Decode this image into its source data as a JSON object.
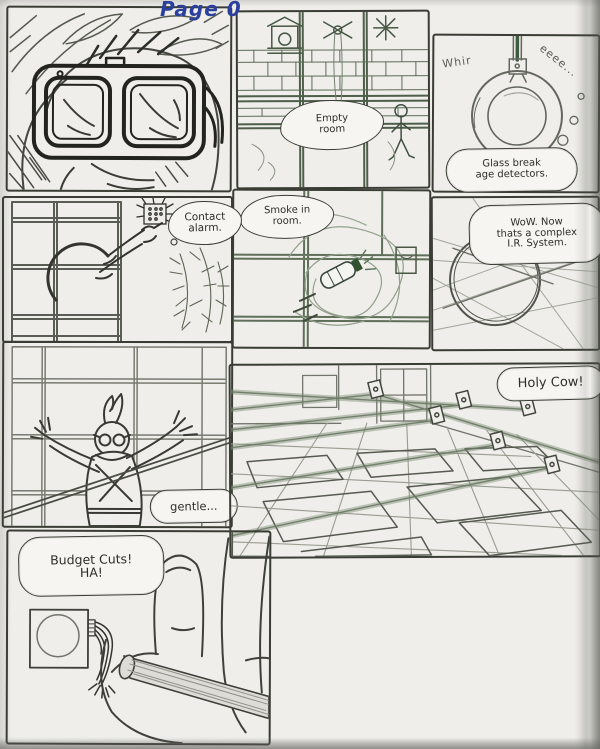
{
  "title": "Page 0",
  "palette": {
    "paper": "#efeeea",
    "pencil": "#3c3e38",
    "pencil_green": "#4e5e4a",
    "title_ink": "#2b3f9e"
  },
  "bubbles": {
    "empty_room": {
      "line1": "Empty",
      "line2": "room"
    },
    "glass_break": {
      "sfx_left": "Whir",
      "sfx_right": "eeee...",
      "line1": "Glass break",
      "line2": "age detectors."
    },
    "contact_alarm": {
      "line1": "Contact",
      "line2": "alarm."
    },
    "smoke": {
      "line1": "Smoke in",
      "line2": "room."
    },
    "ir_system": {
      "line1": "WoW. Now",
      "line2": "thats a complex",
      "line3": "I.R. System."
    },
    "gentle": {
      "line1": "gentle..."
    },
    "holy_cow": {
      "line1": "Holy Cow!"
    },
    "budget_cuts": {
      "line1": "Budget Cuts!",
      "line2": "HA!"
    }
  }
}
